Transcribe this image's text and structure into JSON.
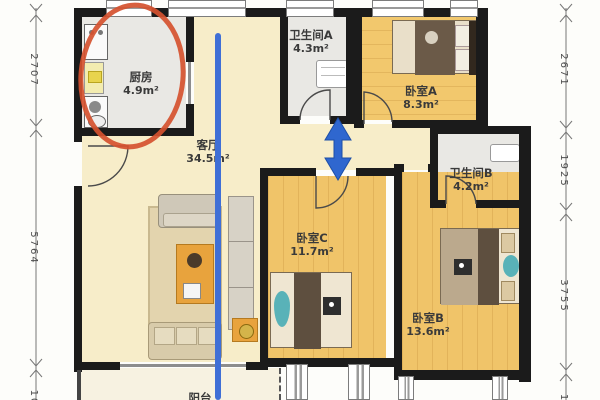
{
  "rooms": [
    {
      "name": "厨房",
      "area": "4.9m²"
    },
    {
      "name": "客厅",
      "area": "34.5m²"
    },
    {
      "name": "卫生间A",
      "area": "4.3m²"
    },
    {
      "name": "卧室A",
      "area": "8.3m²"
    },
    {
      "name": "卫生间B",
      "area": "4.2m²"
    },
    {
      "name": "卧室C",
      "area": "11.7m²"
    },
    {
      "name": "卧室B",
      "area": "13.6m²"
    },
    {
      "name": "阳台",
      "area": ""
    }
  ],
  "dimensions": {
    "left": [
      "2707",
      "5764",
      "10"
    ],
    "right": [
      "2671",
      "1925",
      "3755",
      "1"
    ]
  },
  "annotations": {
    "red_circle": {
      "target": "厨房",
      "color": "#d5512f"
    },
    "blue_line": {
      "color": "#3f6fd6"
    },
    "blue_double_arrow": {
      "color": "#2f67cf"
    }
  },
  "palette": {
    "wall": "#1b1b1b",
    "wood_floor": "#f0c469",
    "cream_floor": "#f7edc9",
    "tile_floor": "#e9e8e4",
    "balcony_floor": "#f7f2e1"
  }
}
